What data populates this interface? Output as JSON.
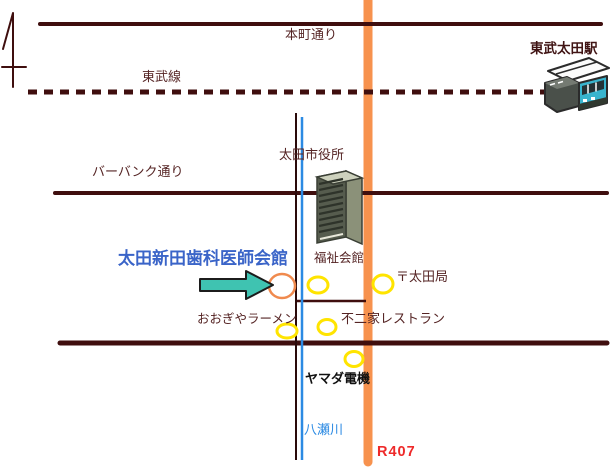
{
  "map": {
    "labels": {
      "honcho_street": "本町通り",
      "tobu_line": "東武線",
      "tobu_ota_station": "東武太田駅",
      "ota_city_hall": "太田市役所",
      "burbank_street": "バーバンク通り",
      "dental_hall": "太田新田歯科医師会館",
      "fukushi_kaikan": "福祉会館",
      "ota_post_office": "〒太田局",
      "oogiya_ramen": "おおぎやラーメン",
      "fujiya_restaurant": "不二家レストラン",
      "yamada_denki": "ヤマダ電機",
      "yase_river": "八瀬川",
      "r407": "R407"
    },
    "colors": {
      "road": "#3f0e0e",
      "railway": "#3f0e0e",
      "river_blue": "#2b8ae3",
      "river_bank": "#2a0a0a",
      "route_orange": "#f7924e",
      "poi_yellow": "#ffe400",
      "target_orange": "#f08a4e",
      "arrow_teal": "#3fc3b1"
    }
  }
}
